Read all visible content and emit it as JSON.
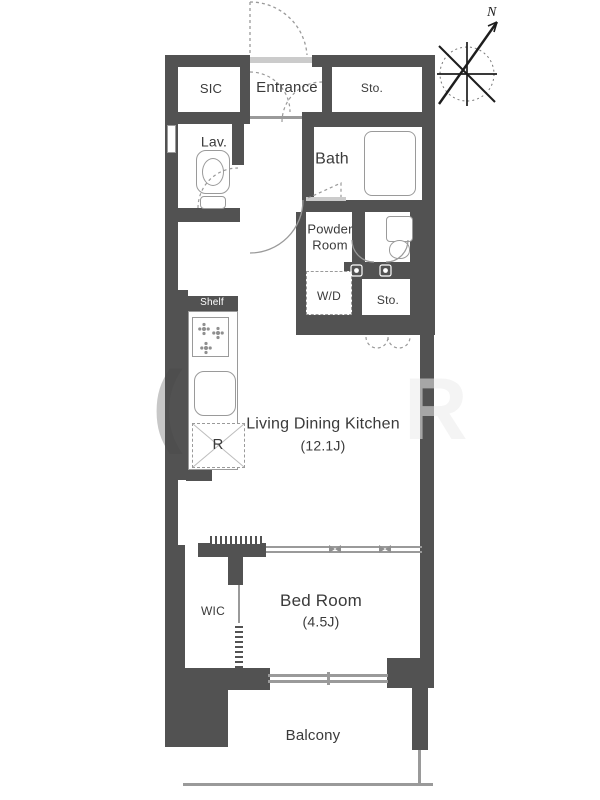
{
  "rooms": {
    "sic": "SIC",
    "entrance": "Entrance",
    "storage_top": "Sto.",
    "lavatory": "Lav.",
    "bath": "Bath",
    "powder_room": "Powder Room",
    "washer_dryer": "W/D",
    "storage_mid": "Sto.",
    "shelf": "Shelf",
    "living_dining_kitchen": "Living Dining Kitchen",
    "ldk_size": "(12.1J)",
    "refrigerator": "R",
    "walk_in_closet": "WIC",
    "bedroom": "Bed Room",
    "bedroom_size": "(4.5J)",
    "balcony": "Balcony"
  },
  "compass": {
    "north": "N"
  },
  "watermark": {
    "left_glyph": "(",
    "right_glyph": "R"
  },
  "colors": {
    "wall": "#525252",
    "line": "#9a9a9a",
    "text": "#3a3a3a",
    "sill": "#cbcbcb"
  }
}
